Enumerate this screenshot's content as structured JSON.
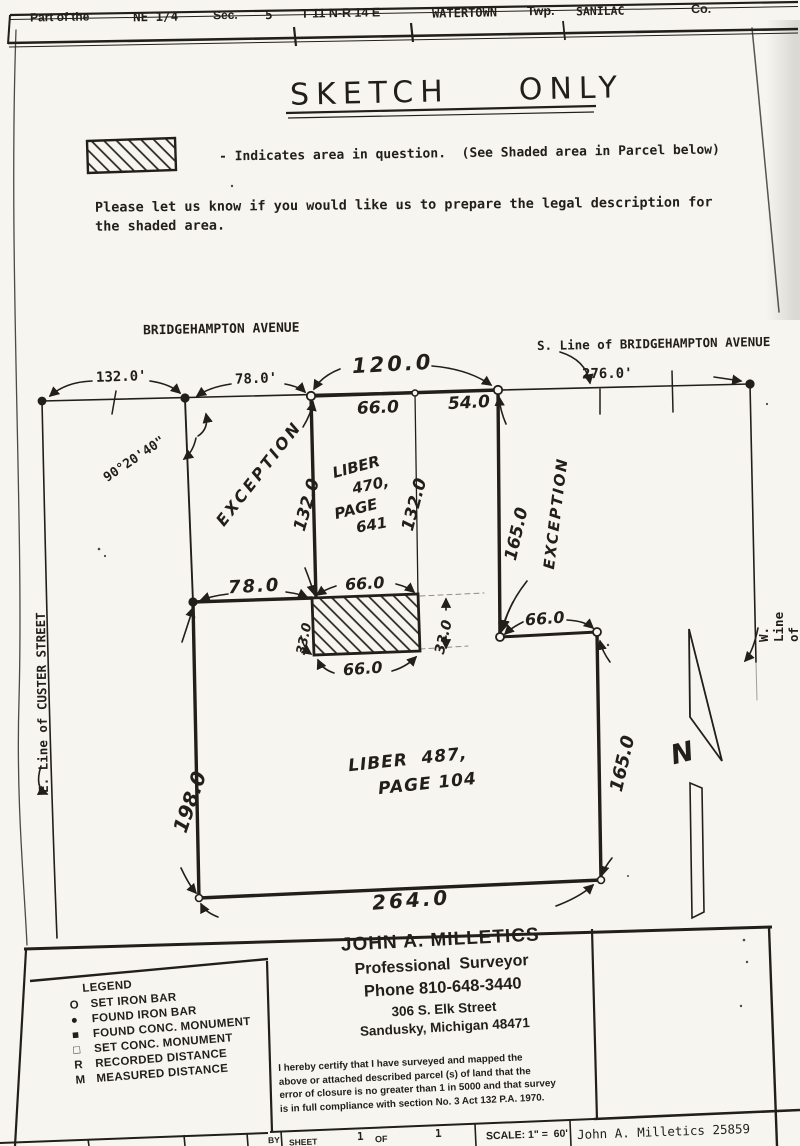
{
  "header": {
    "part_of_the": "Part of the",
    "quarter": "NE 1/4",
    "sec_label": "Sec.",
    "sec_value": "5",
    "township_range": "T 11 N-R 14 E",
    "township_name": "WATERTOWN",
    "twp_label": "Twp.",
    "county_name": "SANILAC",
    "co_label": "Co."
  },
  "title": "SKETCH  ONLY",
  "notes": {
    "hatch_note": "- Indicates area in question.  (See Shaded area in Parcel below)",
    "request_line1": "Please let us know if you would like us to prepare the legal description for",
    "request_line2": "the shaded area."
  },
  "drawing": {
    "streets": {
      "bridgehampton": "BRIDGEHAMPTON AVENUE",
      "s_line_bridgehampton": "S. Line of BRIDGEHAMPTON AVENUE",
      "e_line_custer": "E. Line of CUSTER STREET",
      "w_line_austin": "W. Line of AUSTIN STREET"
    },
    "dims": {
      "top_132": "132.0'",
      "top_78": "78.0'",
      "top_120": "120.0",
      "top_66": "66.0",
      "top_54": "54.0",
      "top_276": "276.0'",
      "left_132": "132.0",
      "mid_132": "132.0",
      "upper_165": "165.0",
      "mid_78": "78.0",
      "hatch_top_66": "66.0",
      "hatch_left_33": "33.0",
      "hatch_right_33": "33.0",
      "hatch_bottom_66": "66.0",
      "mid_66": "66.0",
      "lower_165": "165.0",
      "left_198": "198.0",
      "bottom_264": "264.0"
    },
    "labels": {
      "angle": "90°20'40\"",
      "exception_left": "EXCEPTION",
      "exception_right": "EXCEPTION",
      "north": "N"
    },
    "parcels": {
      "l470_w1": "LIBER",
      "l470_w2": "470,",
      "l470_w3": "PAGE",
      "l470_w4": "641",
      "l487_line1": "LIBER  487,",
      "l487_line2": "PAGE 104"
    }
  },
  "legend": {
    "title": "LEGEND",
    "items": [
      {
        "symbol": "O",
        "label": "SET IRON BAR"
      },
      {
        "symbol": "●",
        "label": "FOUND IRON BAR"
      },
      {
        "symbol": "■",
        "label": "FOUND CONC. MONUMENT"
      },
      {
        "symbol": "□",
        "label": "SET CONC. MONUMENT"
      },
      {
        "symbol": "R",
        "label": "RECORDED DISTANCE"
      },
      {
        "symbol": "M",
        "label": "MEASURED DISTANCE"
      }
    ]
  },
  "surveyor": {
    "name": "JOHN A. MILLETICS",
    "title": "Professional  Surveyor",
    "phone": "Phone 810-648-3440",
    "address1": "306 S. Elk Street",
    "address2": "Sandusky, Michigan 48471",
    "cert": [
      "I hereby certify that I have surveyed and mapped the",
      "above or attached described parcel (s) of land that the",
      "error of closure is no greater than 1 in 5000 and that survey",
      "is in full compliance with section No. 3 Act 132 P.A. 1970."
    ]
  },
  "footer": {
    "by_label": "BY",
    "sheet_label": "SHEET",
    "sheet_num": "1",
    "of_label": "OF",
    "of_num": "1",
    "scale": "SCALE: 1\" =  60'",
    "signature": "John A. Milletics 25859"
  }
}
